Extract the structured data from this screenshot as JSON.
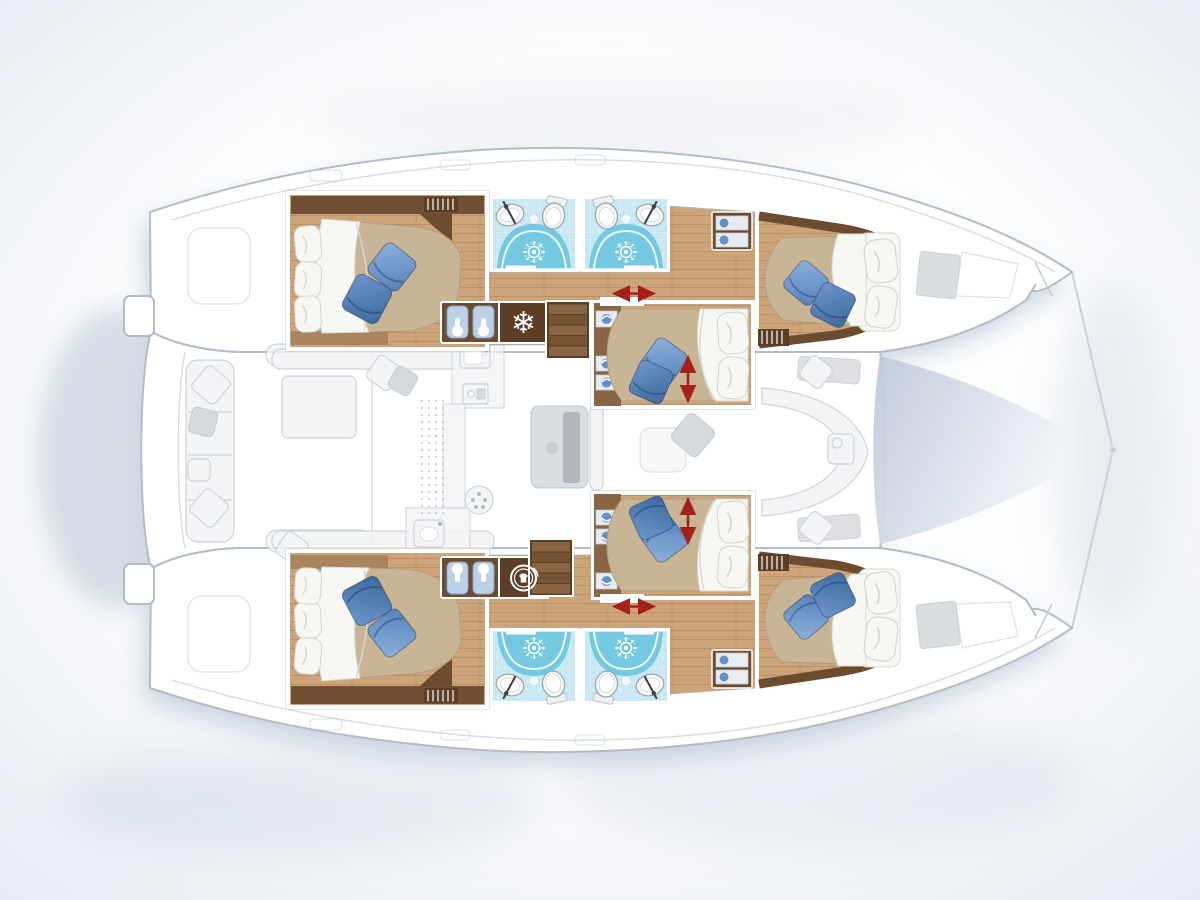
{
  "meta": {
    "type": "yacht-deck-plan",
    "description": "Top view interior layout plan of a sailing catamaran, bows pointing right; saturated rooms are the accommodations in the two hulls and nacelle, deck furniture shown ghosted",
    "visible_text": []
  },
  "colors": {
    "bg_inner": "#fdfdfe",
    "bg_outer": "#e2e8f0",
    "shadow": "#9db1c6",
    "hull_fill": "#ffffff",
    "hull_stroke": "#b4bdc7",
    "deck_line": "#d9dee4",
    "ghost_fill": "#f1f2f4",
    "ghost_stroke": "#c7cdd3",
    "ghost_dark": "#cfd3d7",
    "wood": "#cda47a",
    "wood_dark": "#8a6544",
    "trim": "#6d4b2f",
    "trim_dark": "#5c3d26",
    "mattress": "#c8b595",
    "sheet": "#f7f7f3",
    "sheet_stroke": "#d8d8d1",
    "pillow_blue": "#6490c8",
    "pb1a": "#8fb2dd",
    "pb1b": "#5580b8",
    "pb2a": "#6e96cc",
    "pb2b": "#3c699f",
    "tile": "#c7e7f2",
    "shower": "#74c8e0",
    "fixture": "#f5f7f7",
    "fixture_stroke": "#98a3ab",
    "arrow": "#a6201a",
    "tramp_dark": "#bec9da",
    "tramp_light": "#f0f3f7"
  },
  "icons": {
    "fridge": {
      "name": "snowflake-fridge-icon",
      "glyph": "❄"
    },
    "washer": {
      "name": "washing-machine-icon"
    },
    "shower_head": {
      "name": "shower-head-sun-icon"
    },
    "slide": {
      "name": "red-slide-arrow-icon"
    },
    "wardrobe": {
      "name": "hanging-locker-icon"
    }
  },
  "layout_counts": {
    "double_cabins": 6,
    "shower_rooms": 4,
    "staircases": 2,
    "galley_sink_units": 2,
    "refrigerators": 1,
    "washing_machines": 1
  },
  "rooms": {
    "port_hull": [
      "aft-double-cabin",
      "shower-room",
      "shower-room",
      "mid-double-cabin",
      "forward-double-cabin"
    ],
    "starboard_hull": [
      "aft-double-cabin",
      "shower-room",
      "shower-room",
      "mid-double-cabin",
      "forward-double-cabin"
    ],
    "main_deck_ghosted": [
      "aft-cockpit-bench",
      "cockpit-table",
      "salon-galley",
      "salon-table",
      "forward-cockpit-seating",
      "trampoline"
    ]
  }
}
